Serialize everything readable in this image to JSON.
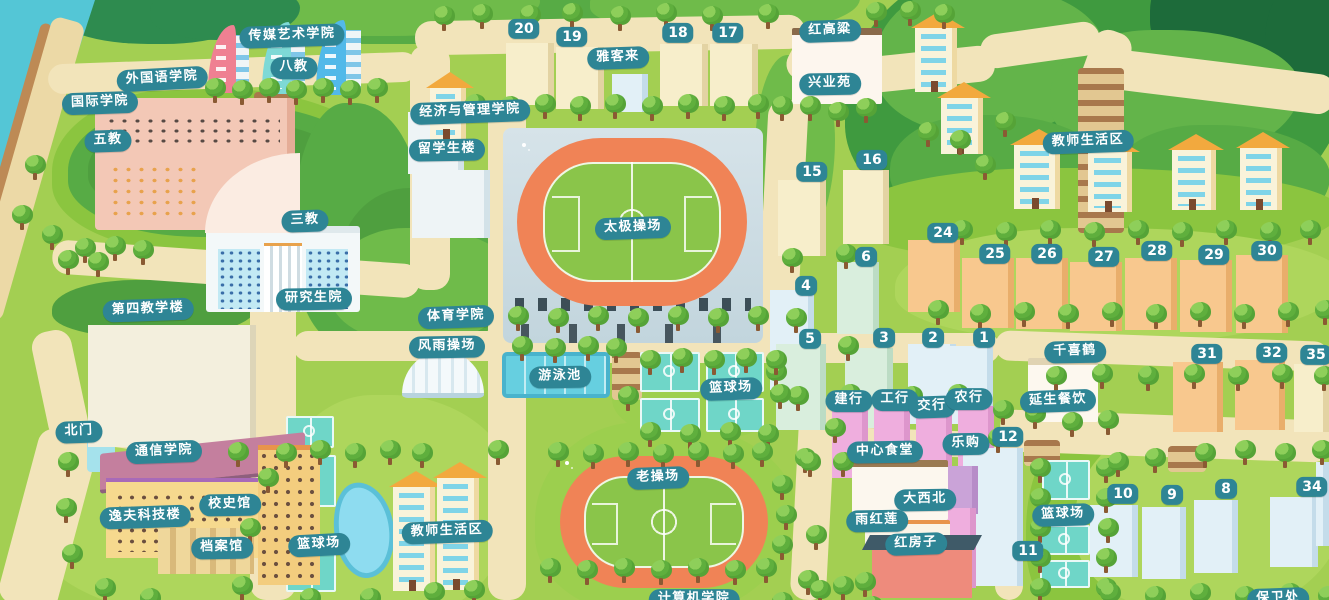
{
  "map_title": "校园卡通地图",
  "colors": {
    "label_bg": "#2e8595",
    "label_text": "#ffffff",
    "road": "#f2e4ba",
    "grass": "#a3cf52",
    "forest": "#3f9a3f",
    "forest_deep": "#1d6b3a",
    "water": "#54c6d6",
    "sand": "#ecd9a6",
    "track": "#f08356",
    "field": "#8ac54a",
    "court": "#6fd6c8",
    "pool": "#66cfe0",
    "pond": "#8edcf0",
    "tree": "#5faf3d",
    "trunk": "#8a5a33"
  },
  "labels": {
    "chuanmei": "传媒艺术学院",
    "bajiao": "八教",
    "waiguoyu": "外国语学院",
    "guoji": "国际学院",
    "wujiao": "五教",
    "jingguan": "经济与管理学院",
    "liuxuesheng": "留学生楼",
    "yakelai": "雅客来",
    "honggaoliang": "红高粱",
    "xingyeyuan": "兴业苑",
    "jiaoshi_right": "教师生活区",
    "sanjiao": "三教",
    "yanjiushengyuan": "研究生院",
    "disijiaoxuelou": "第四教学楼",
    "tiyuxueyuan": "体育学院",
    "fengyucaochang": "风雨操场",
    "taijicaochang": "太极操场",
    "youyongchi": "游泳池",
    "lanqiu_mid": "篮球场",
    "beimen": "北门",
    "tongxinxueyuan": "通信学院",
    "xiaoshiguan": "校史馆",
    "yifukejilou": "逸夫科技楼",
    "danganguan": "档案馆",
    "lanqiu_left": "篮球场",
    "jiaoshi_bottom": "教师生活区",
    "laocaochang": "老操场",
    "qianxihe": "千喜鹤",
    "yanshengcanyin": "延生餐饮",
    "jianhang": "建行",
    "gonghang": "工行",
    "jiaohang": "交行",
    "nonghang": "农行",
    "zhongxinshitang": "中心食堂",
    "legou": "乐购",
    "daxibei": "大西北",
    "yuhonglian": "雨红莲",
    "hongfangzi": "红房子",
    "lanqiu_right": "篮球场",
    "jisuanji": "计算机学院",
    "baoweichu": "保卫处"
  },
  "badges": {
    "b20": "20",
    "b19": "19",
    "b18": "18",
    "b17": "17",
    "b15": "15",
    "b16": "16",
    "b6": "6",
    "b4": "4",
    "b5": "5",
    "b3": "3",
    "b2": "2",
    "b1": "1",
    "b24": "24",
    "b25": "25",
    "b26": "26",
    "b27": "27",
    "b28": "28",
    "b29": "29",
    "b30": "30",
    "b31": "31",
    "b32": "32",
    "b35": "35",
    "b12": "12",
    "b11": "11",
    "b10": "10",
    "b9": "9",
    "b8": "8",
    "b34": "34"
  }
}
